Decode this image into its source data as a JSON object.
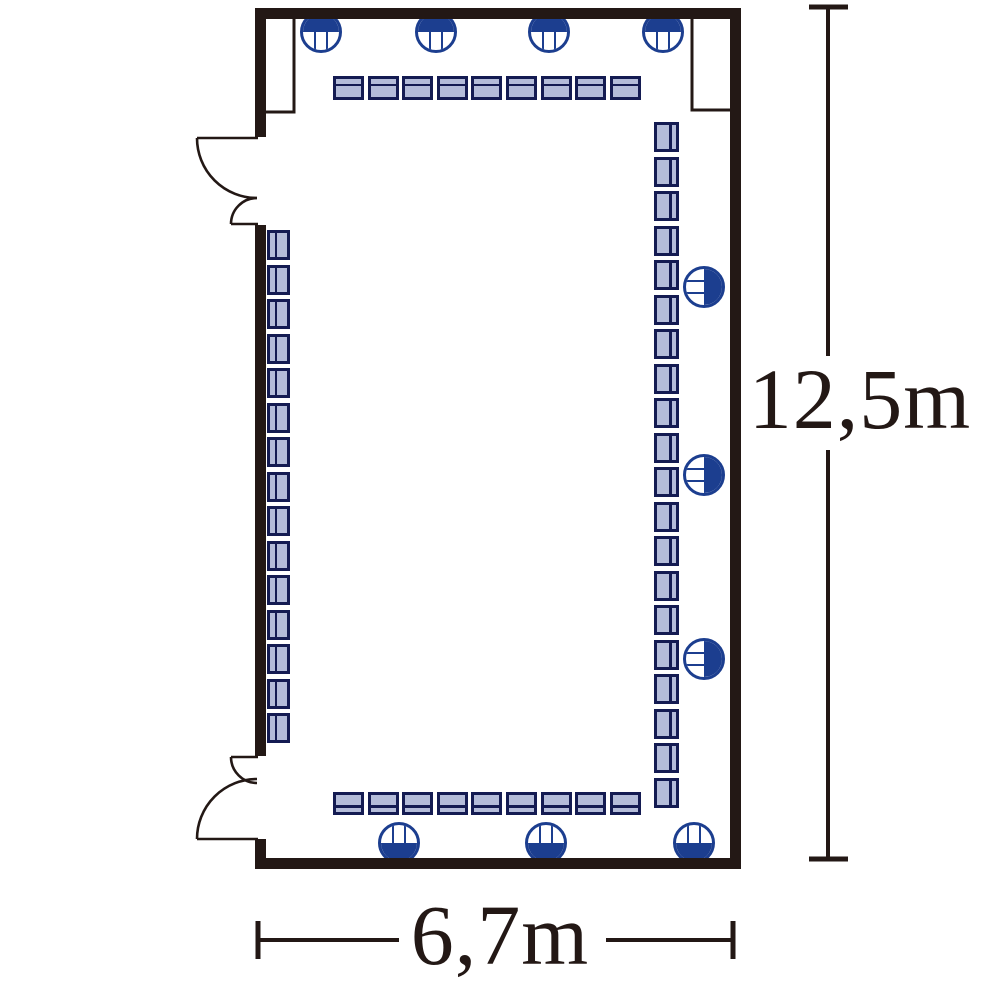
{
  "labels": {
    "height_dimension": "12,5m",
    "width_dimension": "6,7m"
  },
  "colors": {
    "wall": "#231815",
    "navy": "#1c3e8f",
    "chair_border": "#141b52",
    "chair_fill": "#b4bcd9",
    "background": "#ffffff"
  },
  "fixtures": {
    "radius": 21,
    "chair_rows": [
      {
        "name": "top-row",
        "count": 9,
        "x": 333,
        "y": 76,
        "w": 31,
        "h": 24,
        "pitch": 34.6,
        "dir": "h",
        "backrest": "top"
      },
      {
        "name": "bottom-row",
        "count": 9,
        "x": 333,
        "y": 792,
        "w": 31,
        "h": 23,
        "pitch": 34.6,
        "dir": "h",
        "backrest": "bottom"
      },
      {
        "name": "left-column",
        "count": 15,
        "x": 267,
        "y": 230,
        "w": 23,
        "h": 30,
        "pitch": 34.5,
        "dir": "v",
        "backrest": "left"
      },
      {
        "name": "right-column",
        "count": 20,
        "x": 654,
        "y": 122,
        "w": 25,
        "h": 30,
        "pitch": 34.5,
        "dir": "v",
        "backrest": "right"
      }
    ],
    "round_chairs": [
      {
        "cx": 321,
        "cy": 32,
        "variant": "top"
      },
      {
        "cx": 436,
        "cy": 32,
        "variant": "top"
      },
      {
        "cx": 549,
        "cy": 32,
        "variant": "top"
      },
      {
        "cx": 663,
        "cy": 32,
        "variant": "top"
      },
      {
        "cx": 704,
        "cy": 287,
        "variant": "right"
      },
      {
        "cx": 704,
        "cy": 475,
        "variant": "right"
      },
      {
        "cx": 704,
        "cy": 659,
        "variant": "right"
      },
      {
        "cx": 399,
        "cy": 843,
        "variant": "bottom"
      },
      {
        "cx": 546,
        "cy": 843,
        "variant": "bottom"
      },
      {
        "cx": 694,
        "cy": 843,
        "variant": "bottom"
      }
    ]
  }
}
